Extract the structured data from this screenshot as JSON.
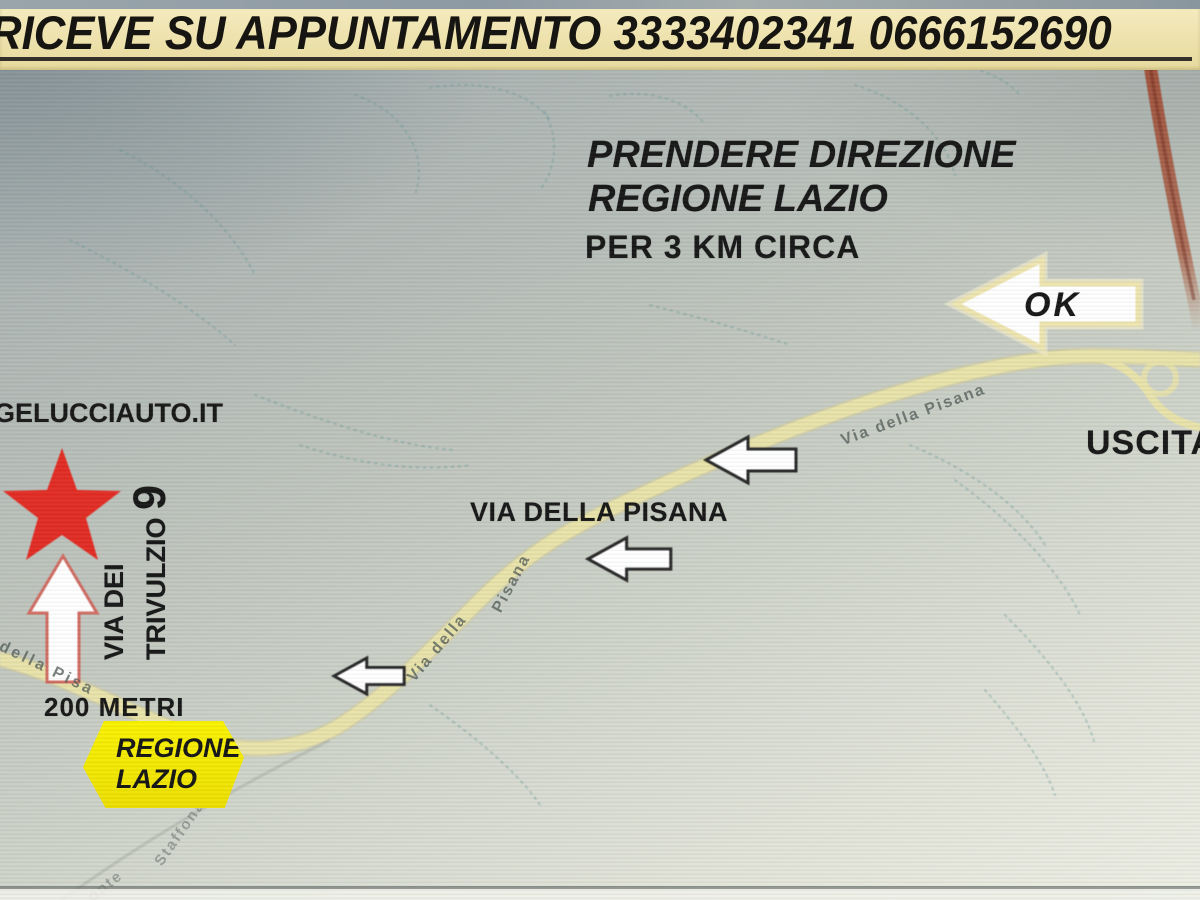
{
  "header": {
    "text": "RICEVE SU APPUNTAMENTO 3333402341  0666152690"
  },
  "instructions": {
    "line1": "PRENDERE DIREZIONE",
    "line2": "REGIONE LAZIO",
    "line3": "PER 3 KM CIRCA"
  },
  "annotations": {
    "ok": "OK",
    "exit": "USCITA",
    "website": "GELUCCIAUTO.IT",
    "street_line1": "VIA DEI",
    "street_line2": "TRIVULZIO",
    "street_number": "9",
    "distance": "200 METRI",
    "road_name": "VIA DELLA PISANA",
    "badge_line1": "REGIONE",
    "badge_line2": "LAZIO"
  },
  "road_labels": [
    {
      "text": "della  Pisa"
    },
    {
      "text": "Via  della"
    },
    {
      "text": "Pisana"
    },
    {
      "text": "Via   della   Pisana"
    },
    {
      "text": "Staffonara"
    },
    {
      "text": "onte"
    }
  ],
  "colors": {
    "banner_bg": "#eee2a9",
    "star_red": "#e12b22",
    "road_yellow": "#e7e1a8",
    "badge_yellow": "#f7ef00",
    "highway_brown": "#a9553a",
    "arrow_white": "#ffffff",
    "text_black": "#161616"
  }
}
